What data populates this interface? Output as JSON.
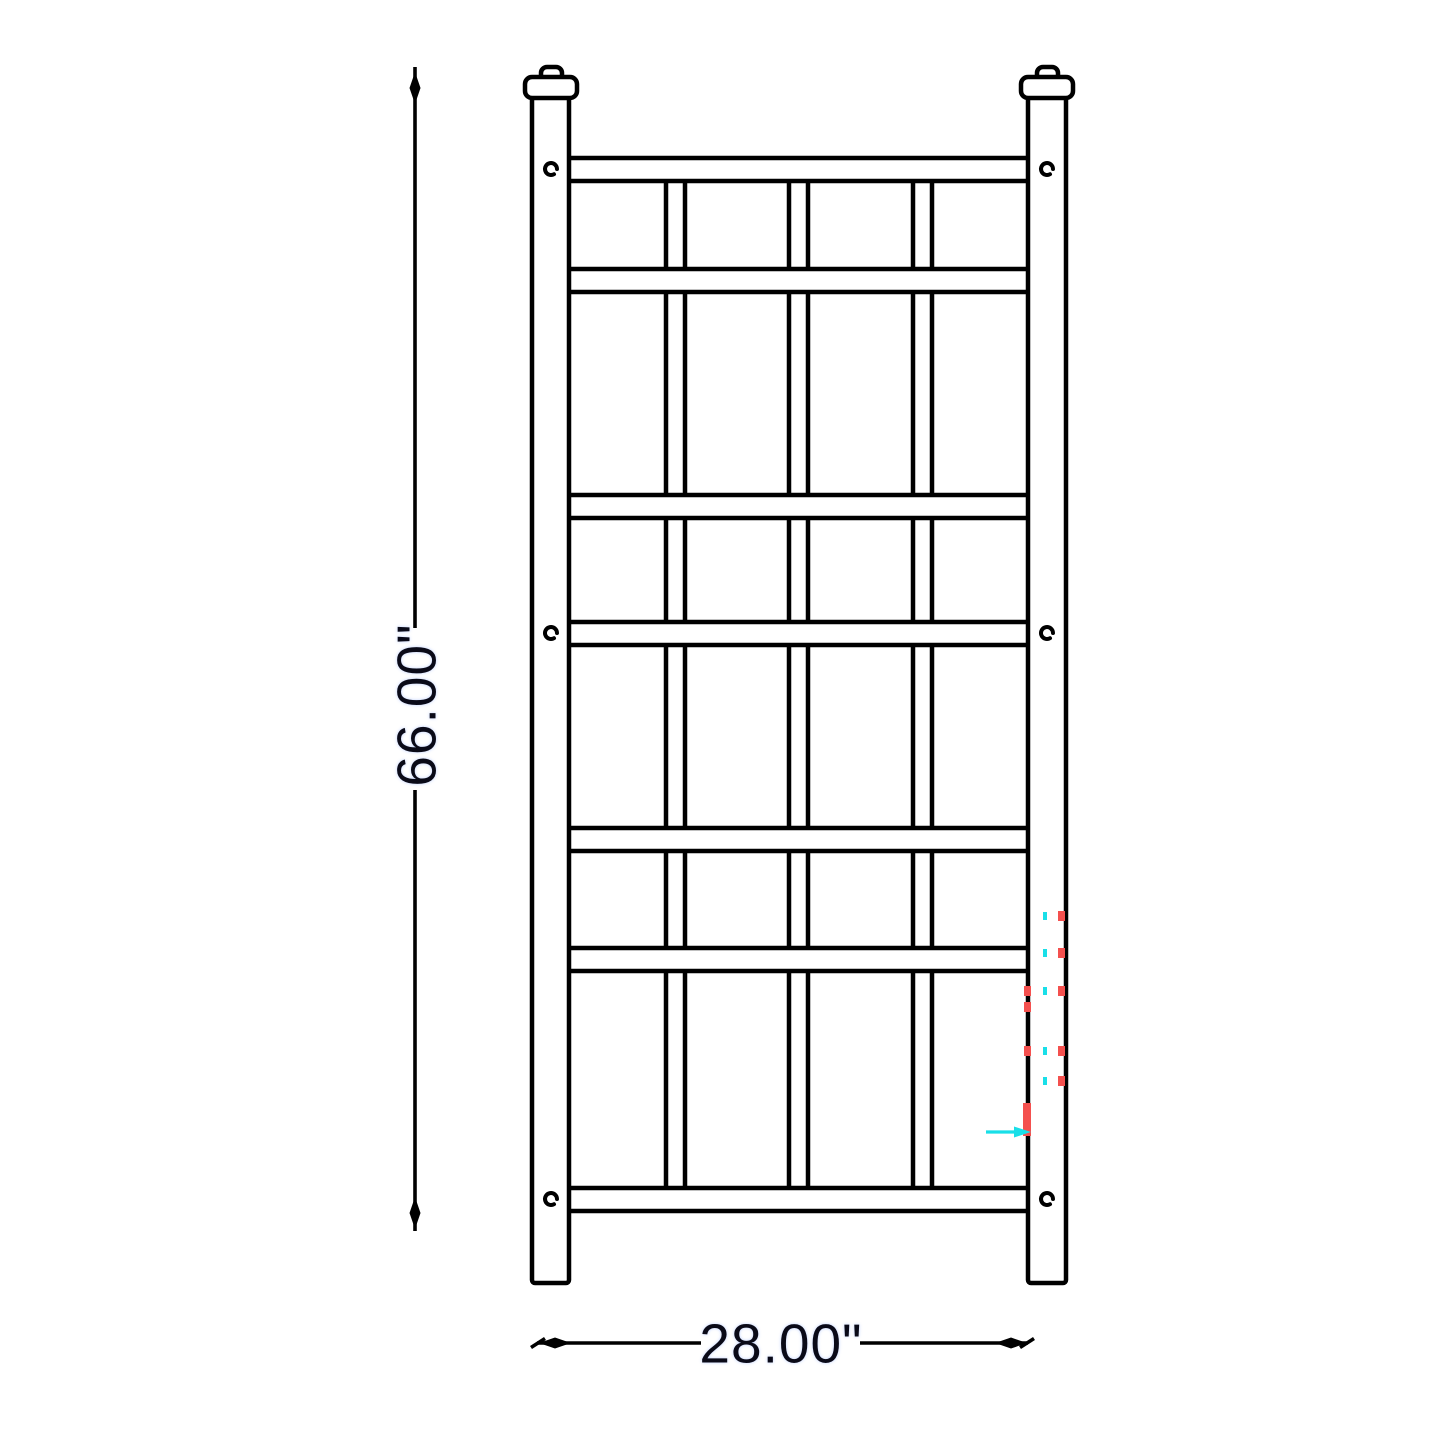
{
  "page": {
    "title": "Trellis product dimension drawing"
  },
  "dimensions": {
    "height_label": "66.00\"",
    "width_label": "28.00\""
  },
  "colors": {
    "background": "#ffffff",
    "line": "#000000",
    "text": "#0a0a18",
    "artifact_red": "#f4504e",
    "artifact_cyan": "#19dfe8"
  },
  "geometry": {
    "canvas": {
      "w": 1445,
      "h": 1445
    },
    "posts": [
      {
        "x": 532,
        "y": 95,
        "w": 37,
        "h": 1188
      },
      {
        "x": 1028,
        "y": 95,
        "w": 38,
        "h": 1188
      }
    ],
    "knobs": [
      {
        "x": 541,
        "y": 67,
        "w": 21,
        "h": 18
      },
      {
        "x": 1037,
        "y": 67,
        "w": 21,
        "h": 18
      }
    ],
    "caps": [
      {
        "x": 525,
        "y": 77,
        "w": 52,
        "h": 21
      },
      {
        "x": 1021,
        "y": 77,
        "w": 52,
        "h": 21
      }
    ],
    "panel": {
      "x": 567,
      "w": 464
    },
    "rail_h": 23,
    "rails_y": [
      158,
      269,
      495,
      622,
      828,
      948,
      1188
    ],
    "slat_w": 19,
    "slats_x": [
      666,
      789,
      913
    ],
    "slat_rows": [
      [
        181,
        269
      ],
      [
        292,
        495
      ],
      [
        518,
        622
      ],
      [
        645,
        828
      ],
      [
        851,
        948
      ],
      [
        971,
        1188
      ]
    ],
    "screw_r": 6,
    "screws": [
      [
        551,
        169
      ],
      [
        1047,
        169
      ],
      [
        551,
        633
      ],
      [
        1047,
        633
      ],
      [
        551,
        1199
      ],
      [
        1047,
        1199
      ]
    ],
    "vdim": {
      "x": 415,
      "seg1": [
        67,
        628
      ],
      "seg2": [
        790,
        1231
      ],
      "label_cx": 417,
      "label_cy": 705
    },
    "hdim": {
      "y": 1343,
      "seg1": [
        537,
        701
      ],
      "seg2": [
        860,
        1028
      ],
      "label_cx": 781,
      "label_cy": 1344
    },
    "artifacts": {
      "red_dashes": [
        [
          1024,
          986
        ],
        [
          1024,
          1002
        ],
        [
          1024,
          1046
        ],
        [
          1058,
          911
        ],
        [
          1058,
          948
        ],
        [
          1058,
          986
        ],
        [
          1058,
          1046
        ],
        [
          1058,
          1076
        ]
      ],
      "red_dash_size": [
        7,
        10
      ],
      "red_bar": [
        1023,
        1103,
        8,
        33
      ],
      "cyan_dots": [
        [
          1043,
          912
        ],
        [
          1043,
          949
        ],
        [
          1043,
          987
        ],
        [
          1043,
          1047
        ],
        [
          1043,
          1077
        ]
      ],
      "cyan_dot_size": [
        4,
        8
      ],
      "cyan_arrow": {
        "x1": 986,
        "x2": 1016,
        "y": 1132,
        "tip": 1031,
        "half": 5.5
      }
    }
  }
}
